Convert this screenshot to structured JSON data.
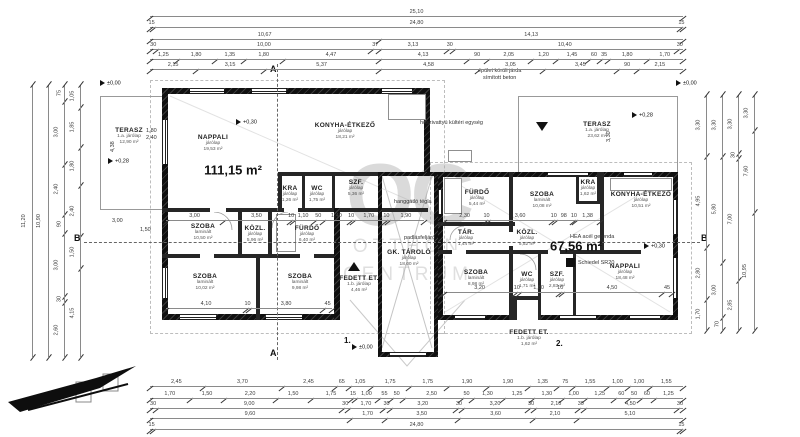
{
  "watermark": {
    "oc": "OC",
    "line1": "OTTHON",
    "line2": "CENTRUM"
  },
  "left_house": {
    "total_area": "111,15 m²",
    "rooms": [
      {
        "name": "TERASZ",
        "floor": "1.a. járólap",
        "area": "12,90 m²"
      },
      {
        "name": "NAPPALI",
        "floor": "járólap",
        "area": "19,53 m²"
      },
      {
        "name": "KONYHA-ÉTKEZŐ",
        "floor": "járólap",
        "area": "18,21 m²"
      },
      {
        "name": "KRA",
        "floor": "járólap",
        "area": "1,26 m²"
      },
      {
        "name": "WC",
        "floor": "járólap",
        "area": "1,75 m²"
      },
      {
        "name": "SZF.",
        "floor": "járólap",
        "area": "5,36 m²"
      },
      {
        "name": "SZOBA",
        "floor": "laminált",
        "area": "10,50 m²"
      },
      {
        "name": "KÖZL.",
        "floor": "járólap",
        "area": "5,96 m²"
      },
      {
        "name": "FÜRDŐ",
        "floor": "járólap",
        "area": "6,40 m²"
      },
      {
        "name": "SZOBA",
        "floor": "laminált",
        "area": "10,02 m²"
      },
      {
        "name": "SZOBA",
        "floor": "laminált",
        "area": "9,98 m²"
      },
      {
        "name": "FEDETT ET.",
        "floor": "1.b. járólap",
        "area": "4,46 m²"
      }
    ]
  },
  "garage": {
    "rooms": [
      {
        "name": "GK. TÁROLÓ",
        "floor": "járólap",
        "area": "18,00 m²"
      }
    ]
  },
  "right_house": {
    "total_area": "67,56 m²",
    "rooms": [
      {
        "name": "TERASZ",
        "floor": "1.a. járólap",
        "area": "23,62 m²"
      },
      {
        "name": "FÜRDŐ",
        "floor": "járólap",
        "area": "5,44 m²"
      },
      {
        "name": "SZOBA",
        "floor": "laminált",
        "area": "10,08 m²"
      },
      {
        "name": "KRA",
        "floor": "járólap",
        "area": "1,62 m²"
      },
      {
        "name": "KONYHA-ÉTKEZŐ",
        "floor": "járólap",
        "area": "10,51 m²"
      },
      {
        "name": "TÁR.",
        "floor": "járólap",
        "area": "1,44 m²"
      },
      {
        "name": "KÖZL.",
        "floor": "járólap",
        "area": "5,52 m²"
      },
      {
        "name": "SZOBA",
        "floor": "laminált",
        "area": "8,98 m²"
      },
      {
        "name": "WC",
        "floor": "járólap",
        "area": "1,71 m²"
      },
      {
        "name": "SZF.",
        "floor": "járólap",
        "area": "2,83 m²"
      },
      {
        "name": "NAPPALI",
        "floor": "járólap",
        "area": "18,48 m²"
      },
      {
        "name": "FEDETT ET.",
        "floor": "1.b. járólap",
        "area": "1,62 m²"
      }
    ]
  },
  "annotations": {
    "jarda1": "épület körüli járda",
    "jarda2": "símított beton",
    "hoszivattyu": "hőszivattyú kültéri egység",
    "hanggatlo": "hanggátló tégla",
    "padlasfeljaro": "padlásfeljáró",
    "hea": "HEA acél gerenda",
    "schiedel": "Schiedel SR20",
    "no1": "1.",
    "no2": "2.",
    "sec_a": "A",
    "sec_b": "B"
  },
  "levels": {
    "nappali": "+0,30",
    "terasz_left": "+0,28",
    "zero_topleft": "±0,00",
    "zero_topright": "±0,00",
    "zero_bottom": "±0,00",
    "terasz_right": "+0,28",
    "right_b": "+0,30"
  },
  "window_dims": {
    "w1": "1,80",
    "w2": "2,40",
    "v_left": "4,38",
    "v_right": "3,30",
    "d1": "3,00",
    "d2": "1,50"
  },
  "dims": {
    "top": [
      [
        "25,10"
      ],
      [
        "15",
        "24,80",
        "15"
      ],
      [
        "10,67",
        "14,13"
      ],
      [
        "30",
        "10,00",
        "37",
        "3,13",
        "30",
        "10,40",
        "30"
      ],
      [
        "1,25",
        "1,80",
        "1,35",
        "1,80",
        "4,47",
        "4,13",
        "90",
        "2,05",
        "1,20",
        "1,45",
        "60",
        "35",
        "1,80",
        "1,70"
      ],
      [
        "2,15",
        "3,15",
        "5,37",
        "4,58",
        "3,05",
        "3,45",
        "90",
        "2,15"
      ]
    ],
    "bottom": [
      [
        "2,45",
        "3,70",
        "2,45",
        "65",
        "1,05",
        "1,75",
        "1,75",
        "1,90",
        "1,90",
        "1,35",
        "75",
        "1,55",
        "1,00",
        "1,00",
        "1,55"
      ],
      [
        "1,70",
        "1,50",
        "2,20",
        "1,50",
        "1,75",
        "15",
        "1,00",
        "55",
        "50",
        "2,50",
        "50",
        "1,30",
        "1,25",
        "1,30",
        "1,00",
        "1,25",
        "60",
        "50",
        "60",
        "1,25"
      ],
      [
        "30",
        "9,00",
        "30",
        "1,70",
        "30",
        "3,20",
        "30",
        "3,20",
        "30",
        "2,10",
        "30",
        "4,50",
        "30"
      ],
      [
        "9,60",
        "1,70",
        "3,50",
        "3,60",
        "2,10",
        "5,10"
      ],
      [
        "15",
        "24,80",
        "15"
      ]
    ],
    "left": [
      [
        "11,20"
      ],
      [
        "10,90"
      ],
      [
        "75",
        "3,00",
        "2,40",
        "90",
        "3,00",
        "30",
        "2,60"
      ],
      [
        "1,05",
        "1,85",
        "1,80",
        "2,40",
        "1,50",
        "4,15"
      ]
    ],
    "right": [
      [
        "3,30",
        "4,95",
        "2,80",
        "1,70"
      ],
      [
        "3,30",
        "5,80",
        "3,00",
        "70"
      ],
      [
        "3,30",
        "30",
        "7,00",
        "2,85"
      ],
      [
        "3,30",
        "7,60",
        "10,95"
      ]
    ],
    "inner_left1": [
      "3,00",
      "3,50",
      "10",
      "1,10",
      "50",
      "1,40",
      "10",
      "1,70",
      "10",
      "1,90"
    ],
    "inner_left2": [
      "4,10",
      "10",
      "3,80",
      "45"
    ],
    "inner_right1": [
      "2,30",
      "10",
      "3,60",
      "10",
      "98",
      "10",
      "1,38"
    ],
    "inner_right2": [
      "3,20",
      "10",
      "1,80",
      "10",
      "4,50",
      "45"
    ]
  }
}
